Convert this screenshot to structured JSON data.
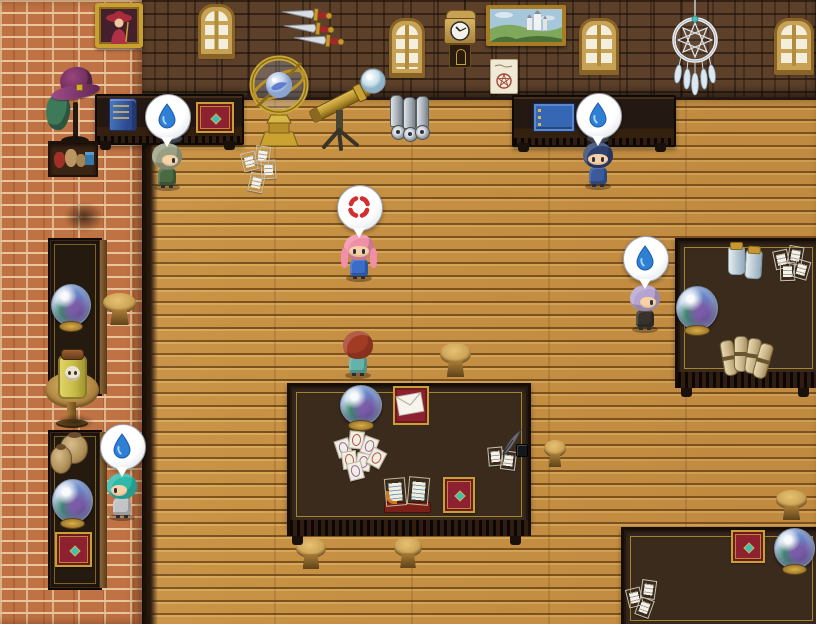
{
  "scene": {
    "viewport_label": "top-down RPG room - fortune teller's study",
    "no_visible_text": true
  },
  "palette": {
    "floor_wood": "#c89245",
    "floor_gap": "#7c521f",
    "wall_brown": "#5c402a",
    "brick_orange": "#bf7243",
    "brick_mortar": "#e8c59b",
    "table_dark": "#3a2b1d",
    "table_frame": "#150d07",
    "gold": "#c9a036",
    "water_mid": "#2f7fd4",
    "water_light": "#a8d6f4",
    "anger": "#d42f2f",
    "bubble": "#ffffff",
    "red_book": "#8e2130",
    "teal_gem": "#3ec0b8",
    "parchment": "#efe9d6",
    "stool_wood": "#cfa458",
    "crystal_glass": "#c7d6ec",
    "crystal_purple": "#7a5ca8",
    "crystal_green": "#3c8a6c",
    "silver": "#c2c8d0"
  },
  "characters": [
    {
      "id": "gray-haired-scholar",
      "hair_color": "#9aa084",
      "outfit_color": "#4b6a42",
      "hair_style": "short",
      "facing": "right",
      "emote": "sweat",
      "x": 150,
      "y": 141
    },
    {
      "id": "blue-beret-sailor",
      "hair_color": "#2e4170",
      "outfit_color": "#3a5a9c",
      "hair_style": "short",
      "facing": "down",
      "emote": "sweat",
      "x": 581,
      "y": 140
    },
    {
      "id": "pink-haired-girl",
      "hair_color": "#f28fa8",
      "outfit_color": "#3a6cc8",
      "hair_style": "long",
      "facing": "down",
      "emote": "anger",
      "x": 342,
      "y": 232
    },
    {
      "id": "auburn-haired-visitor",
      "hair_color": "#a23b24",
      "outfit_color": "#63b3ab",
      "hair_style": "short",
      "facing": "up",
      "emote": null,
      "x": 341,
      "y": 329
    },
    {
      "id": "lavender-haired-teller",
      "hair_color": "#b5a3d0",
      "outfit_color": "#37322b",
      "hair_style": "short",
      "facing": "right",
      "emote": "sweat",
      "x": 628,
      "y": 283
    },
    {
      "id": "teal-haired-apprentice",
      "hair_color": "#2fb9aa",
      "outfit_color": "#c2c4c6",
      "hair_style": "short",
      "facing": "left",
      "emote": "sweat",
      "x": 105,
      "y": 471
    }
  ],
  "emotes": {
    "sweat_drop_label": "sweat drop balloon",
    "anger_label": "anger balloon"
  },
  "props": {
    "portrait_label": "portrait painting",
    "window_label": "arched window",
    "daggers_label": "wall-mounted daggers",
    "clock_label": "pendulum wall clock",
    "landscape_label": "castle landscape painting",
    "poster_label": "magic circle poster",
    "dreamcatcher_label": "dreamcatcher",
    "armillary_label": "brass armillary sphere",
    "telescope_label": "brass telescope",
    "tubes_label": "metal scroll tubes",
    "desk_label": "wall desk",
    "crystal_ball_label": "crystal ball",
    "skull_jar_label": "specimen jar with skull",
    "round_table_label": "round side table",
    "tall_table_label": "side table",
    "stool_label": "wooden stool",
    "hat_stand_label": "hat stand with witch hat",
    "shelf_label": "shelf with pouches",
    "central_table_label": "large reading table",
    "right_table_label": "work table",
    "bottom_table_label": "corner table",
    "tarot_label": "scattered tarot cards",
    "open_book_label": "open spell book",
    "red_book_label": "ornate red grimoire",
    "envelope_label": "envelope on mat",
    "quill_label": "quill and ink",
    "papers_label": "scattered notes",
    "scrolls_label": "bundled scrolls",
    "jars_label": "glass jars",
    "pots_label": "clay pots",
    "blue_book_label": "blue book",
    "ledger_label": "blue ledger",
    "tapestry_label": "ornate tapestry mat"
  },
  "inventory": {
    "left_desk_items": [
      "blue book",
      "crystal ball",
      "ornate tapestry mat"
    ],
    "right_desk_items": [
      "blue ledger",
      "crystal ball"
    ],
    "central_table_items": [
      "crystal ball",
      "envelope on mat",
      "tarot cards",
      "open spell book",
      "red grimoire",
      "notes with quill and ink"
    ],
    "right_table_items": [
      "glass jars",
      "notes",
      "crystal ball",
      "bundled scrolls"
    ],
    "bottom_table_items": [
      "red grimoire",
      "crystal ball",
      "notes"
    ],
    "left_tables_items": [
      "crystal ball",
      "skull jar",
      "clay pots",
      "crystal ball",
      "red grimoire"
    ]
  }
}
